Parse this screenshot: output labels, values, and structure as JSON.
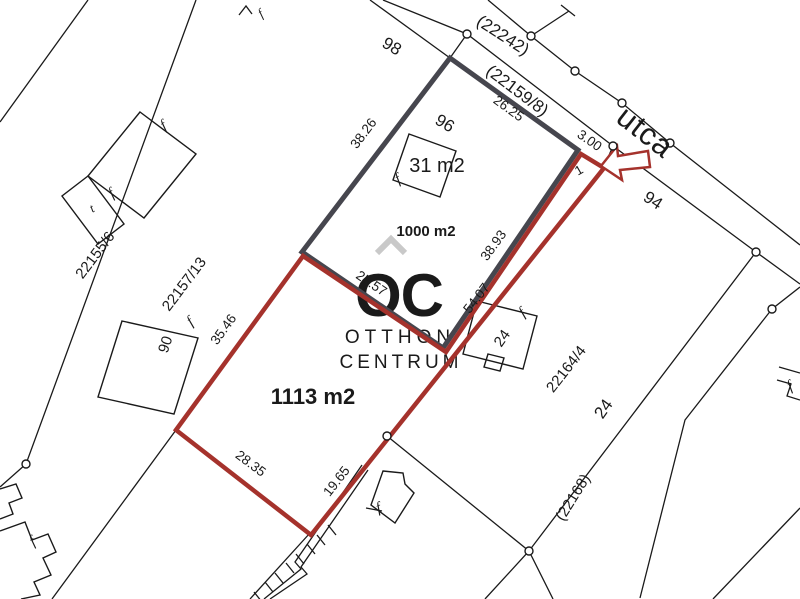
{
  "watermark": {
    "line1": "OC",
    "line2": "OTTHON",
    "line3": "CENTRUM",
    "caret": "^"
  },
  "streets": {
    "utca": "utca",
    "road_top": "(22242)",
    "road_mid": "(22159/8)",
    "road_bottom": "(22168)"
  },
  "parcels": {
    "left": "22155/6",
    "mid_left": "22157/13",
    "right": "22164/4"
  },
  "house_numbers": {
    "n98": "98",
    "n96": "96",
    "n94": "94",
    "n90": "90",
    "n24_building": "24",
    "n24_parcel": "24"
  },
  "areas": {
    "building": "31 m2",
    "plot_gray": "1000 m2",
    "plot_red": "1113 m2"
  },
  "measurements": {
    "nw_edge": "38.26",
    "street_edge": "26.25",
    "frontage": "3.00",
    "inner_se_edge": "38.93",
    "outer_se_upper": "54.07",
    "shared_sw_edge": "25.57",
    "west_edge": "35.46",
    "south_edge": "28.35",
    "outer_se_lower": "19.65"
  },
  "entrance_number": "1",
  "building_marks": {
    "f": "f",
    "t": "t"
  },
  "colors": {
    "plot_outline_gray": "#46464e",
    "plot_outline_red": "#a5322c",
    "area_blue": "#2b79b5",
    "watermark_gray": "#c9c9c9",
    "line_black": "#1a1a1a"
  }
}
